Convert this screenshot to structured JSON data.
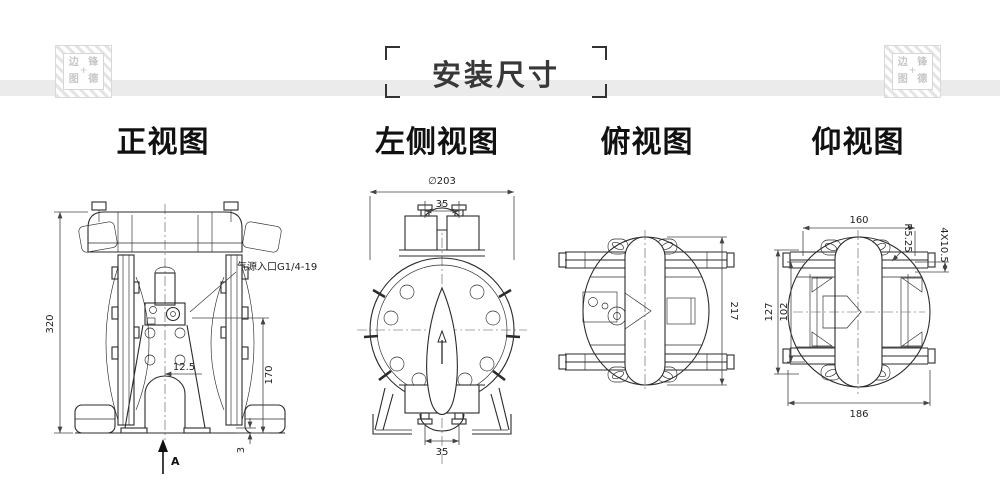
{
  "title": "安装尺寸",
  "stamp": {
    "c1": "边",
    "c2": "锋",
    "c3": "图",
    "c4": "德",
    "plus": "+"
  },
  "colors": {
    "band": "#ebebeb",
    "line": "#2b2b2b",
    "dim": "#444444",
    "stamp": "#c7c7c7",
    "title_text": "#383838"
  },
  "views": {
    "front": {
      "label": "正视图",
      "callout_air_inlet": "气源入口G1/4-19",
      "dim_total_height": "320",
      "dim_inner_height": "170",
      "dim_center_offset": "12.5",
      "dim_foot_height": "3",
      "section_mark": "A"
    },
    "left": {
      "label": "左侧视图",
      "dim_diameter": "∅203",
      "dim_port_width_top": "35",
      "dim_port_width_bottom": "35"
    },
    "top": {
      "label": "俯视图",
      "dim_length": "217"
    },
    "bottom": {
      "label": "仰视图",
      "dim_width_top": "160",
      "dim_width_bottom": "186",
      "dim_bolt_span_inner": "102",
      "dim_bolt_span_outer": "127",
      "dim_slot_radius": "R5.25",
      "dim_slot_size": "4X10.5"
    }
  }
}
